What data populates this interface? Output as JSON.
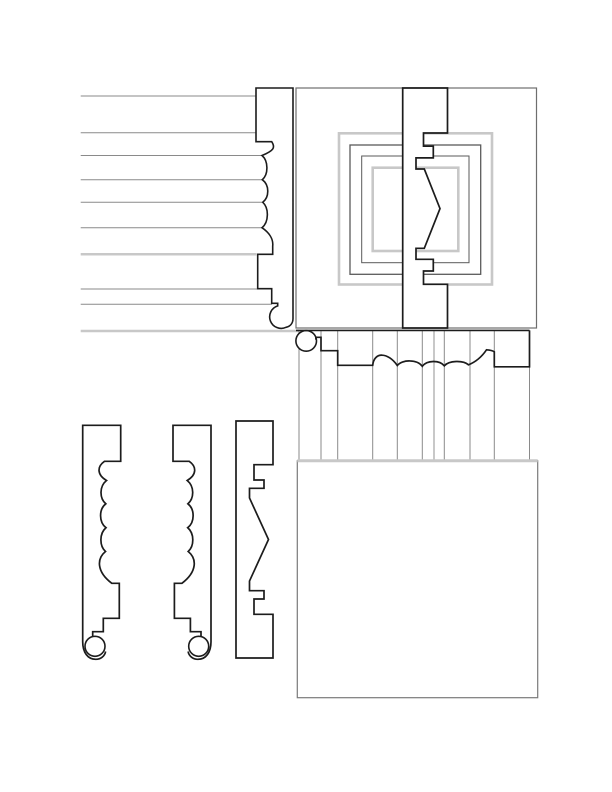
{
  "canvas": {
    "width": 612,
    "height": 792,
    "background": "#ffffff"
  },
  "palette": {
    "ink": "#1c1c1c",
    "gray_line": "#8a8a8a",
    "light_line": "#c8c8c8",
    "frame_gray": "#6e6e6e",
    "mid_gray": "#5a5a5a",
    "wall_gray": "#7a7a7a",
    "fill_white": "#ffffff"
  },
  "sections": [
    {
      "name": "clapboard-siding-section",
      "shapes": [
        {
          "type": "line",
          "x1": 80.7,
          "y1": 96,
          "x2": 256,
          "y2": 96,
          "stroke": "gray_line",
          "w": 1
        },
        {
          "type": "line",
          "x1": 80.7,
          "y1": 132.7,
          "x2": 256,
          "y2": 132.7,
          "stroke": "gray_line",
          "w": 1
        },
        {
          "type": "line",
          "x1": 80.7,
          "y1": 155.5,
          "x2": 262,
          "y2": 155.5,
          "stroke": "gray_line",
          "w": 1
        },
        {
          "type": "line",
          "x1": 80.7,
          "y1": 179.7,
          "x2": 262.3,
          "y2": 179.7,
          "stroke": "gray_line",
          "w": 1
        },
        {
          "type": "line",
          "x1": 80.7,
          "y1": 202.3,
          "x2": 262.8,
          "y2": 202.3,
          "stroke": "gray_line",
          "w": 1
        },
        {
          "type": "line",
          "x1": 80.7,
          "y1": 227.7,
          "x2": 262,
          "y2": 227.7,
          "stroke": "gray_line",
          "w": 1
        },
        {
          "type": "line",
          "x1": 80.7,
          "y1": 254.3,
          "x2": 256.5,
          "y2": 254.3,
          "stroke": "light_line",
          "w": 2.5
        },
        {
          "type": "line",
          "x1": 80.7,
          "y1": 289,
          "x2": 257.7,
          "y2": 289,
          "stroke": "gray_line",
          "w": 1
        },
        {
          "type": "line",
          "x1": 80.7,
          "y1": 304.3,
          "x2": 272,
          "y2": 304.3,
          "stroke": "gray_line",
          "w": 1
        },
        {
          "type": "line",
          "x1": 80.7,
          "y1": 331,
          "x2": 299,
          "y2": 331,
          "stroke": "light_line",
          "w": 2.5
        }
      ]
    },
    {
      "name": "side-casing-profile",
      "shapes": [
        {
          "type": "path",
          "stroke": "ink",
          "w": 1.6,
          "fill": "fill_white",
          "d": "M 256,88 L 293,88 L 293,318.5 C 293,323.5 290,326.4 286,327.3 A 11.5,11.5 0 1 1 277.7,305.9 L 277.7,303.3 L 271.7,303.3 L 271.7,288.7 L 257.7,288.7 L 257.7,254.3 L 272.7,254.3 L 272.7,246 C 273.5,239 269,232.5 262,227.7 C 269,222 269,208 262.8,202.3 C 269.5,197 269.5,185 262.3,179.7 C 268.5,174.5 268.5,161 262,155.5 C 274,150.5 275.5,147.5 271.7,141.7 L 256,141.7 Z"
        }
      ]
    },
    {
      "name": "panel-elevation-section",
      "shapes": [
        {
          "type": "rect",
          "x": 296,
          "y": 88,
          "width": 240.5,
          "height": 240,
          "stroke": "frame_gray",
          "w": 1.2,
          "fill": "none"
        },
        {
          "type": "rect",
          "x": 339,
          "y": 133.3,
          "width": 153,
          "height": 151.2,
          "stroke": "light_line",
          "w": 2.6,
          "fill": "none"
        },
        {
          "type": "rect",
          "x": 350,
          "y": 145,
          "width": 130.7,
          "height": 129.3,
          "stroke": "mid_gray",
          "w": 1.3,
          "fill": "none"
        },
        {
          "type": "rect",
          "x": 361.7,
          "y": 156,
          "width": 107.3,
          "height": 106.7,
          "stroke": "mid_gray",
          "w": 1,
          "fill": "none"
        },
        {
          "type": "rect",
          "x": 372.7,
          "y": 167.7,
          "width": 85.6,
          "height": 83.3,
          "stroke": "light_line",
          "w": 2.6,
          "fill": "none"
        }
      ]
    },
    {
      "name": "panel-molding-section-band",
      "shapes": [
        {
          "type": "path",
          "stroke": "ink",
          "w": 1.7,
          "fill": "fill_white",
          "d": "M 402.7,88 L 447.5,88 L 447.5,133 L 423.5,133 L 423.5,146.2 L 433.3,146.2 L 433.3,157.9 L 416,157.9 L 416,169 L 424.3,169 L 440,208.6 L 424.3,248.3 L 416,248.3 L 416,259.3 L 433.3,259.3 L 433.3,271 L 423.5,271 L 423.5,284.3 L 447.5,284.3 L 447.5,328 L 402.7,328 Z"
        }
      ]
    },
    {
      "name": "fluting-lines",
      "shapes": [
        {
          "type": "line",
          "x1": 299,
          "y1": 330.4,
          "x2": 299,
          "y2": 460.8,
          "stroke": "gray_line",
          "w": 1
        },
        {
          "type": "line",
          "x1": 321,
          "y1": 330.4,
          "x2": 321,
          "y2": 460.8,
          "stroke": "gray_line",
          "w": 1
        },
        {
          "type": "line",
          "x1": 337.7,
          "y1": 330.4,
          "x2": 337.7,
          "y2": 460.8,
          "stroke": "gray_line",
          "w": 1
        },
        {
          "type": "line",
          "x1": 372.7,
          "y1": 330.4,
          "x2": 372.7,
          "y2": 460.8,
          "stroke": "gray_line",
          "w": 1
        },
        {
          "type": "line",
          "x1": 397.3,
          "y1": 330.4,
          "x2": 397.3,
          "y2": 460.8,
          "stroke": "gray_line",
          "w": 1
        },
        {
          "type": "line",
          "x1": 422.3,
          "y1": 330.4,
          "x2": 422.3,
          "y2": 460.8,
          "stroke": "gray_line",
          "w": 1
        },
        {
          "type": "line",
          "x1": 434,
          "y1": 330.4,
          "x2": 434,
          "y2": 460.8,
          "stroke": "light_line",
          "w": 2
        },
        {
          "type": "line",
          "x1": 444.3,
          "y1": 330.4,
          "x2": 444.3,
          "y2": 460.8,
          "stroke": "gray_line",
          "w": 1
        },
        {
          "type": "line",
          "x1": 470,
          "y1": 330.4,
          "x2": 470,
          "y2": 460.8,
          "stroke": "gray_line",
          "w": 1
        },
        {
          "type": "line",
          "x1": 494.3,
          "y1": 330.4,
          "x2": 494.3,
          "y2": 460.8,
          "stroke": "gray_line",
          "w": 1
        },
        {
          "type": "line",
          "x1": 529.5,
          "y1": 366.8,
          "x2": 529.5,
          "y2": 460.8,
          "stroke": "gray_line",
          "w": 1
        }
      ]
    },
    {
      "name": "head-casing-section",
      "shapes": [
        {
          "type": "circle",
          "cx": 306.2,
          "cy": 340.9,
          "r": 10.3,
          "stroke": "ink",
          "w": 1.6,
          "fill": "fill_white"
        },
        {
          "type": "line",
          "x1": 296,
          "y1": 330.4,
          "x2": 529.5,
          "y2": 330.4,
          "stroke": "ink",
          "w": 1.6
        },
        {
          "type": "path",
          "stroke": "ink",
          "w": 1.7,
          "fill": "none",
          "d": "M 315.9,339.6 L 315.9,337.3 L 321,337.3 L 321,350.7 L 337.7,350.7 L 337.7,365.3 L 372.7,365.3 C 374,351.5 388,352 397.3,365.5 C 402,359.5 417,359 422.3,366.3 C 427,360 439.5,360 444.3,365.8 C 449,360.5 463,360 468.5,364.8 C 478,361 484,353.5 486.5,349.8 C 489.5,350 492.5,350.5 494.3,351.8 L 494.3,366.8 L 529.5,366.8 L 529.5,330.4"
        }
      ]
    },
    {
      "name": "wall-panel-rectangle",
      "shapes": [
        {
          "type": "rect",
          "x": 297.3,
          "y": 460.8,
          "width": 240.4,
          "height": 236.9,
          "stroke": "wall_gray",
          "w": 1.2,
          "fill": "none"
        },
        {
          "type": "line",
          "x1": 297.3,
          "y1": 460.8,
          "x2": 537.7,
          "y2": 460.8,
          "stroke": "light_line",
          "w": 3
        }
      ]
    },
    {
      "name": "casing-profile-left",
      "shapes": [
        {
          "type": "path",
          "stroke": "ink",
          "w": 1.7,
          "fill": "none",
          "d": "M 105.6,651.5 C 104.8,656.2 100.6,659.3 95.8,659.3 C 87.6,659.3 82.7,652.2 82.7,641.7 L 82.7,425.3 L 120.7,425.3 L 120.7,461.3 L 104.5,461.3 C 97,466.5 96.8,474.8 106.5,480.5 C 99.3,486.3 99.3,498.2 105.8,503.8 C 98.8,509.3 98.8,522.2 106,527.7 C 99.3,533.5 99.3,545.8 105.5,551.5 C 96.8,558.5 96.3,571.5 111.8,583.3 L 119.3,583.3 L 119.3,618.3 L 103.3,618.3 L 103.3,631.7 L 92.7,631.7 L 92.7,636.3"
        },
        {
          "type": "circle",
          "cx": 95,
          "cy": 646.3,
          "r": 10,
          "stroke": "ink",
          "w": 1.6,
          "fill": "fill_white"
        }
      ]
    },
    {
      "name": "casing-profile-right",
      "shapes": [
        {
          "type": "path",
          "stroke": "ink",
          "w": 1.7,
          "fill": "none",
          "d": "M 188.1,651.5 C 188.9,656.2 193.1,659.3 197.9,659.3 C 206.1,659.3 211,652.2 211,641.7 L 211,425.3 L 173,425.3 L 173,461.3 L 189.2,461.3 C 196.7,466.5 196.9,474.8 187.2,480.5 C 194.4,486.3 194.4,498.2 187.9,503.8 C 194.9,509.3 194.9,522.2 187.7,527.7 C 194.4,533.5 194.4,545.8 188.2,551.5 C 196.9,558.5 197.4,571.5 181.9,583.3 L 174.4,583.3 L 174.4,618.3 L 190.4,618.3 L 190.4,631.7 L 201,631.7 L 201,636.3"
        },
        {
          "type": "circle",
          "cx": 198.7,
          "cy": 646.3,
          "r": 10,
          "stroke": "ink",
          "w": 1.6,
          "fill": "fill_white"
        }
      ]
    },
    {
      "name": "panel-molding-profile",
      "shapes": [
        {
          "type": "path",
          "stroke": "ink",
          "w": 1.7,
          "fill": "fill_white",
          "d": "M 236,421 L 273,421 L 273,464.7 L 254,464.7 L 254,480 L 264,480 L 264,488.3 L 249.5,488.3 L 249.5,498 L 268.5,539.5 L 249.5,581 L 249.5,590.7 L 264,590.7 L 264,599 L 254,599 L 254,614.3 L 273,614.3 L 273,658 L 236,658 Z"
        }
      ]
    }
  ]
}
